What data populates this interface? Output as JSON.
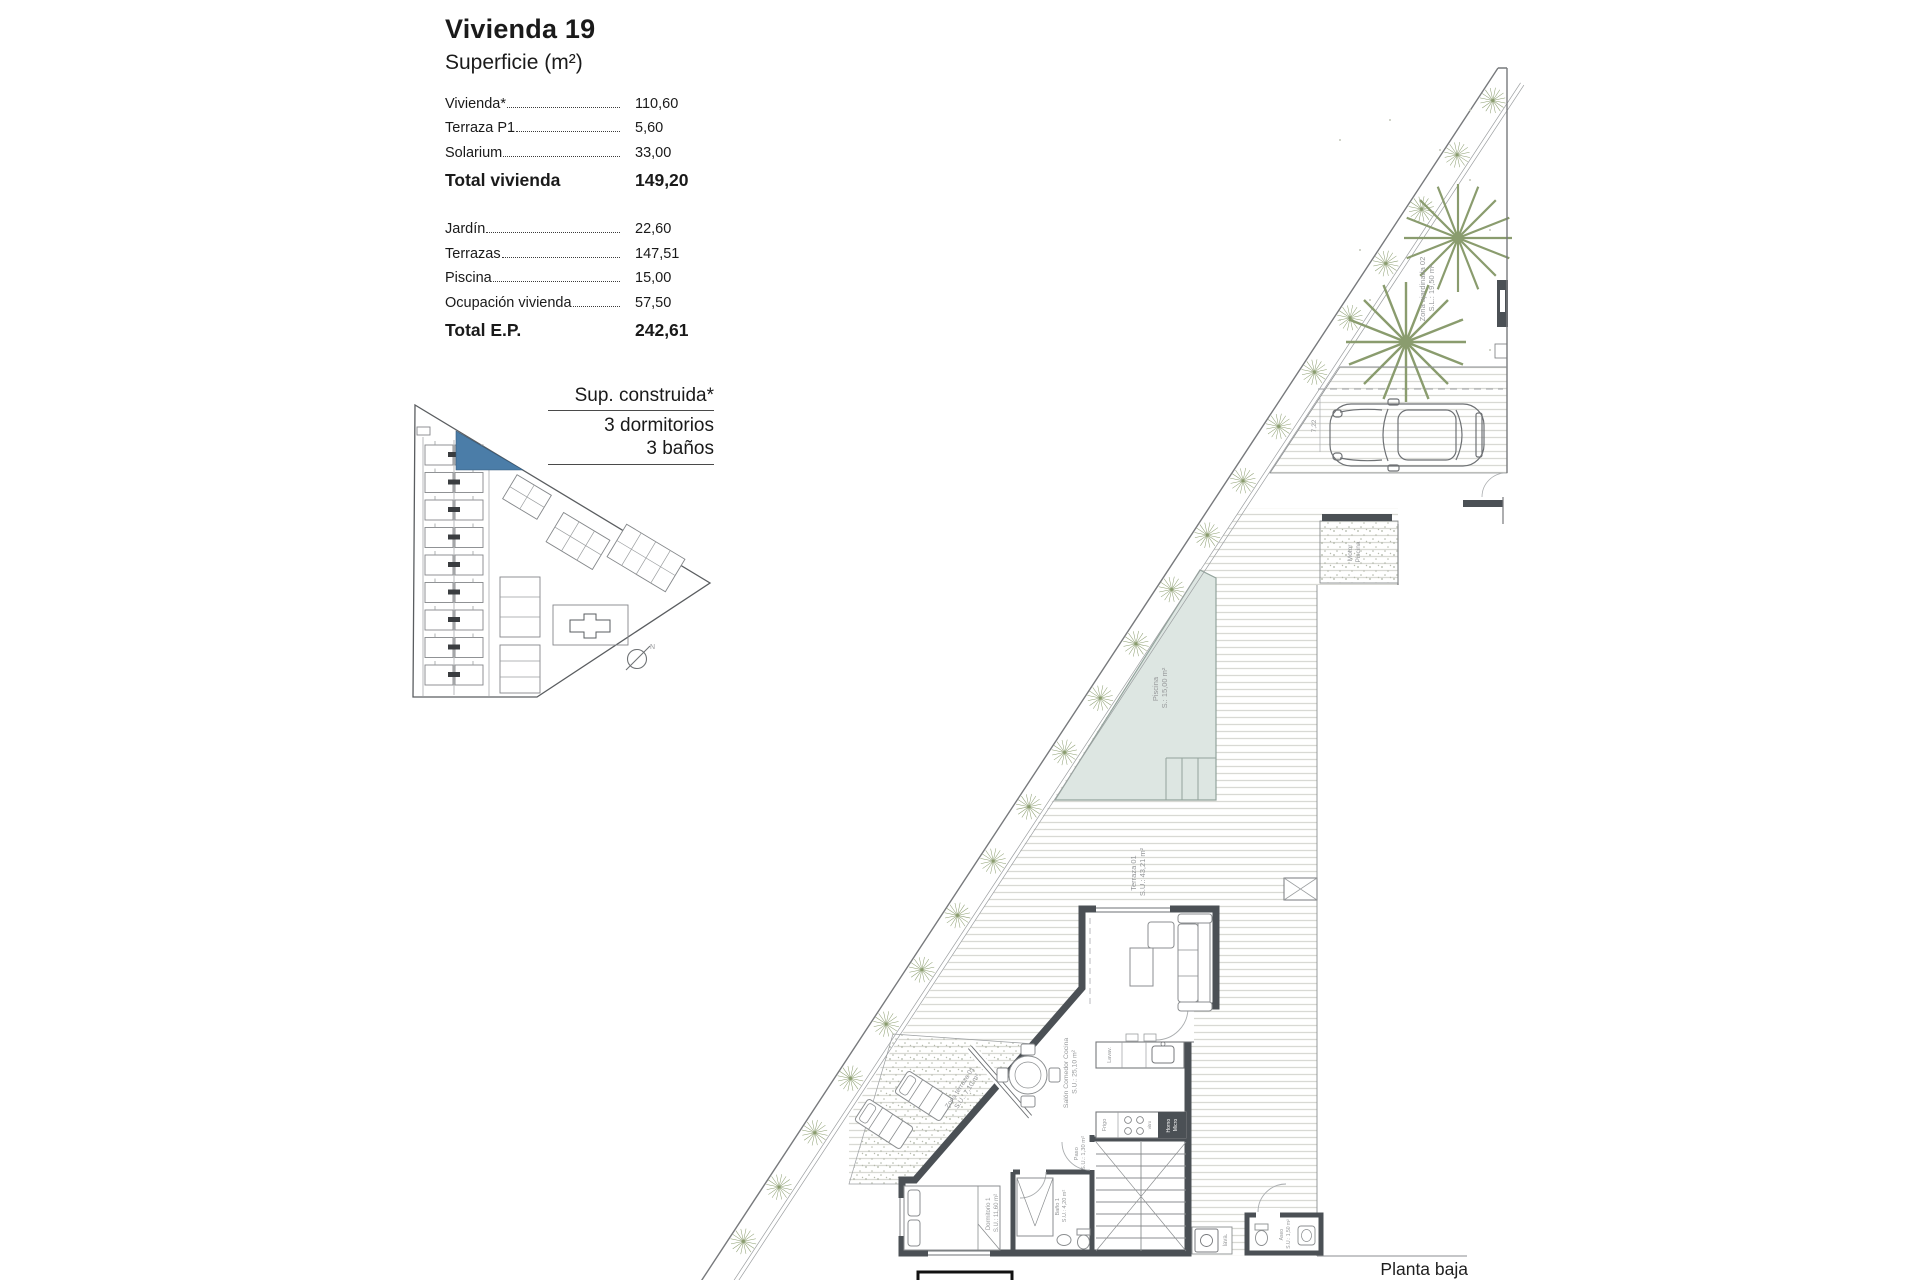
{
  "info_panel": {
    "title": "Vivienda 19",
    "subtitle": "Superficie (m²)",
    "rows1": [
      {
        "label": "Vivienda*",
        "value": "110,60"
      },
      {
        "label": "Terraza P1",
        "value": "5,60"
      },
      {
        "label": "Solarium",
        "value": "33,00"
      }
    ],
    "total1": {
      "label": "Total vivienda",
      "value": "149,20"
    },
    "rows2": [
      {
        "label": "Jardín",
        "value": "22,60"
      },
      {
        "label": "Terrazas",
        "value": "147,51"
      },
      {
        "label": "Piscina",
        "value": "15,00"
      },
      {
        "label": "Ocupación vivienda",
        "value": "57,50"
      }
    ],
    "total2": {
      "label": "Total E.P.",
      "value": "242,61"
    }
  },
  "spec_block": {
    "line1": "Sup. construida*",
    "line2": "3 dormitorios",
    "line3": "3 baños"
  },
  "footer": {
    "label": "Planta baja"
  },
  "compass": {
    "label": "N"
  },
  "plan_labels": {
    "garden_zone": "Zona ajardinada 02",
    "garden_zone_area": "S.L.: 19,50 m²",
    "motor1": "Motor",
    "motor2": "Piscina",
    "pool": "Piscina",
    "pool_area": "S.: 15,00 m²",
    "terrace": "Terraza 01",
    "terrace_area": "S.U.: 43,21 m²",
    "terrace_zone": "Zona terraza 01",
    "terrace_zone_area": "S.U.: 7,10 m²",
    "living": "Salón Comedor Cocina",
    "living_area": "S.U.: 25,10 m²",
    "hall": "Paso",
    "hall_area": "S.U.: 1,30 m²",
    "bedroom": "Dormitorio 1",
    "bedroom_area": "S.U.: 11,60 m²",
    "bath": "Baño 1",
    "bath_area": "S.U.: 4,20 m²",
    "wc": "Aseo",
    "wc_area": "S.U.: 1,50 m²",
    "laundry": "lava.",
    "fridge": "Frigo",
    "dishwasher": "Lavav.",
    "oven1": "Horno",
    "oven2": "Micro",
    "hob": "vitro",
    "parking_dim": "7,22"
  },
  "colors": {
    "highlight_unit": "#4b7da8",
    "wall": "#4b5055",
    "pool_fill": "#dde6e2",
    "pool_stroke": "#93a39c",
    "hedge_green": "#8a9c6e",
    "deck_stripe": "#d8d9d4"
  }
}
